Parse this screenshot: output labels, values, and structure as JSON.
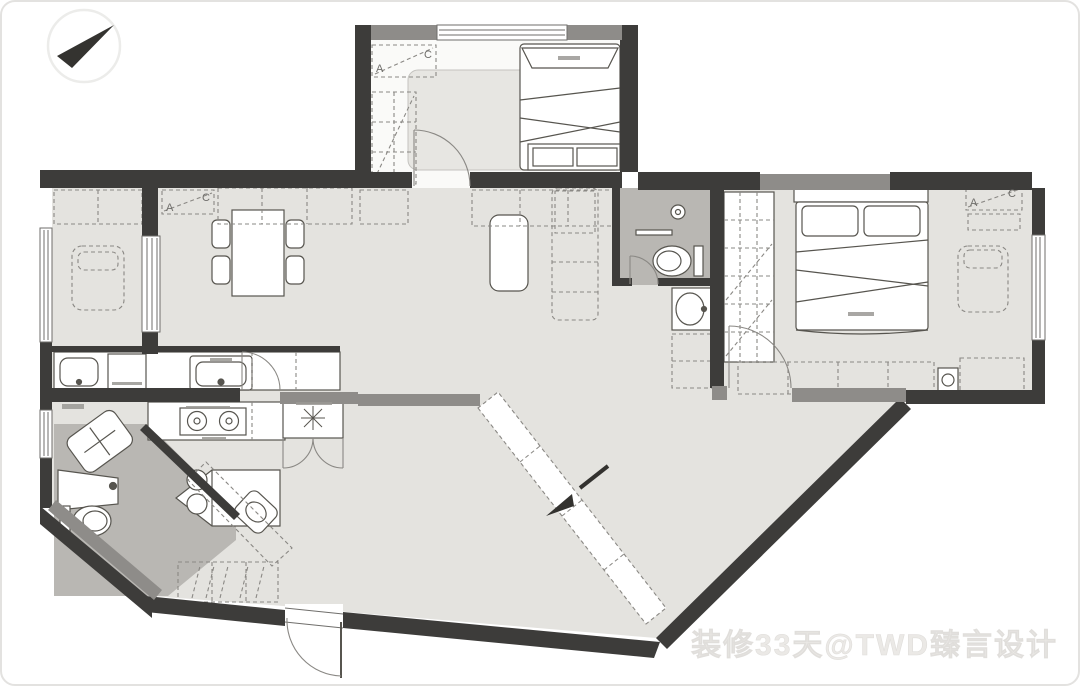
{
  "canvas": {
    "width": 1080,
    "height": 686,
    "background": "#ffffff",
    "border_color": "#e3e2e0"
  },
  "compass": {
    "icon": "north-arrow-icon",
    "needle_color": "#343330",
    "ring_color": "#ececea"
  },
  "watermark": {
    "text": "装修33天@TWD臻言设计",
    "color": "#ebe9e6"
  },
  "colors": {
    "wall_dark": "#3d3c3a",
    "wall_gray": "#8e8c89",
    "floor_main": "#e4e3df",
    "floor_bedroom": "#fafaf8",
    "floor_bath": "#b9b7b3",
    "rug": "#e7e6e2",
    "furniture_stroke": "#57554f",
    "dashed_stroke": "#8a8884",
    "door_stroke": "#8a8884",
    "label_tick": "#9a9894"
  },
  "labels": {
    "ac_a": "A",
    "ac_c": "C"
  },
  "rooms": [
    "north-bedroom",
    "study-room",
    "dining-area",
    "living-hall",
    "bathroom",
    "corridor",
    "master-bedroom",
    "kitchen",
    "guest-bathroom",
    "entry-foyer"
  ],
  "fixtures": [
    "double-bed",
    "foot-bench",
    "wardrobe",
    "area-rug",
    "ac-unit",
    "lounge-chaise",
    "cabinet-row",
    "sliding-door",
    "dining-table",
    "dining-chair",
    "sideboard",
    "console-table",
    "sofa",
    "shower-drain",
    "toilet",
    "vanity-basin",
    "master-bed",
    "bedside-chaise",
    "tv-cabinet",
    "kitchen-counter",
    "kitchen-sink",
    "washer-dryer",
    "laundry-sink",
    "gas-stove",
    "island-table",
    "bar-stool",
    "shoe-cabinet",
    "storage-closet",
    "water-heater",
    "guest-toilet",
    "guest-basin",
    "entry-door",
    "window",
    "entry-arrow"
  ]
}
